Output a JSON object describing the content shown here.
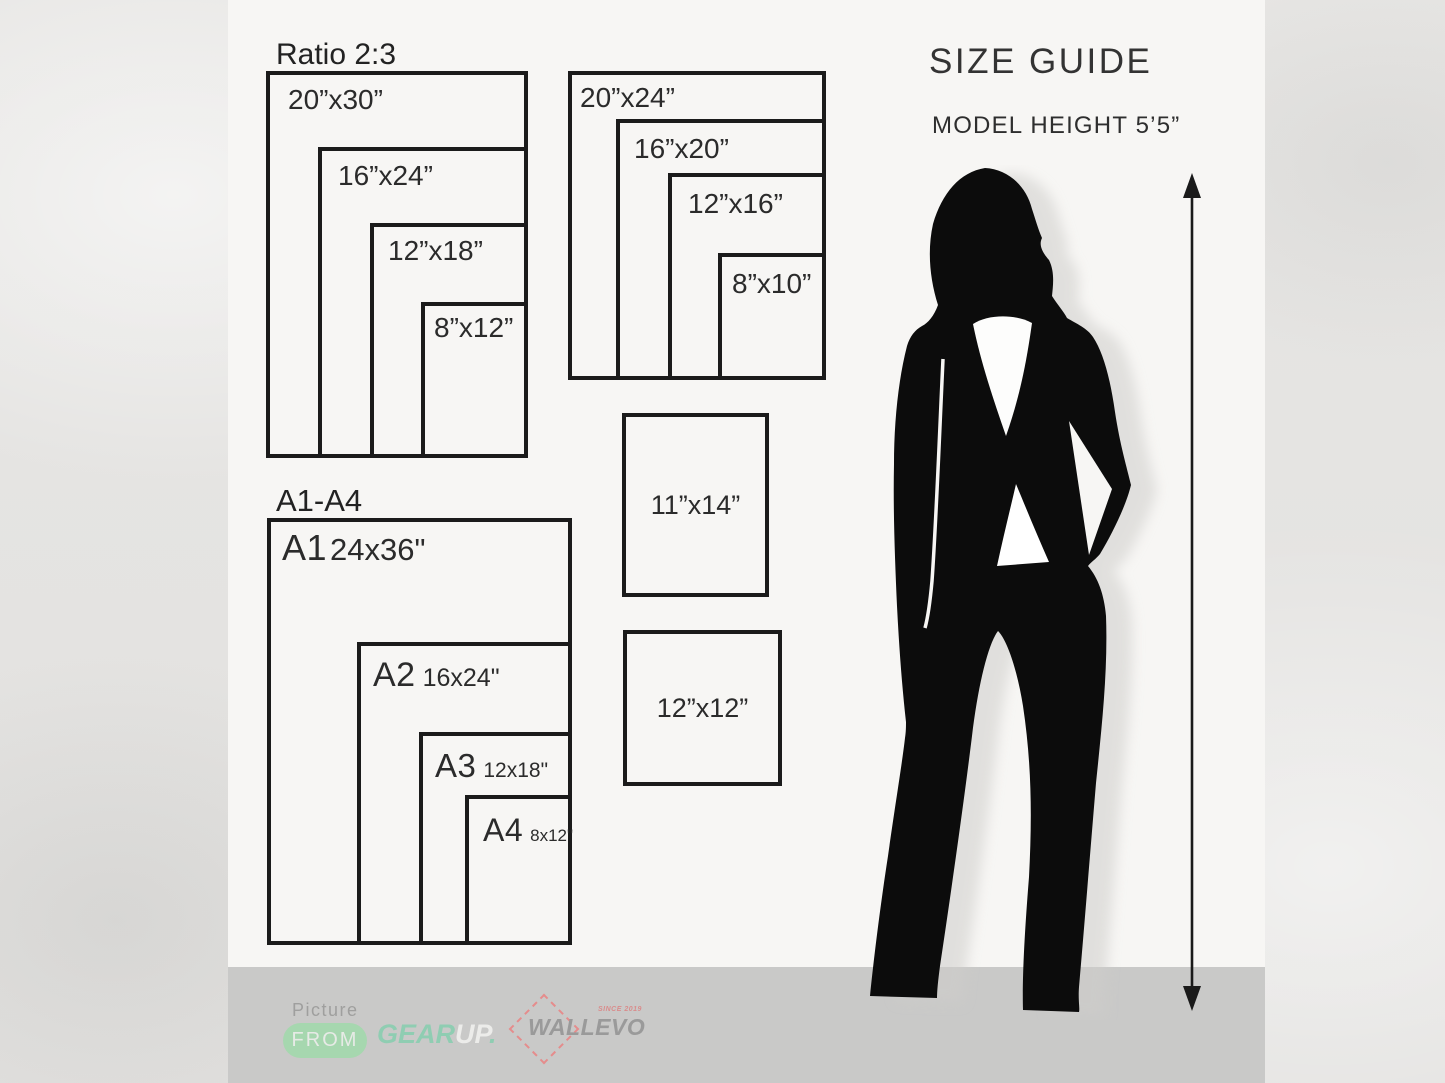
{
  "header": {
    "title": "SIZE GUIDE",
    "model_height": "MODEL HEIGHT 5’5”"
  },
  "ratio_group": {
    "title": "Ratio 2:3",
    "sizes": [
      "20”x30”",
      "16”x24”",
      "12”x18”",
      "8”x12”"
    ]
  },
  "standard_group": {
    "sizes": [
      "20”x24”",
      "16”x20”",
      "12”x16”",
      "8”x10”"
    ]
  },
  "single_sizes": [
    "11”x14”",
    "12”x12”"
  ],
  "a_series": {
    "title": "A1-A4",
    "items": [
      {
        "name": "A1",
        "size": "24x36\""
      },
      {
        "name": "A2",
        "size": "16x24\""
      },
      {
        "name": "A3",
        "size": "12x18\""
      },
      {
        "name": "A4",
        "size": "8x12\""
      }
    ]
  },
  "footer": {
    "picture_label": "Picture",
    "from_badge": "FROM",
    "gearup": {
      "gear": "GEAR",
      "up": "UP",
      "dot": "."
    },
    "wallevo": {
      "name": "WALLEVO",
      "since": "SINCE 2019"
    }
  },
  "colors": {
    "accent_green": "#8fcdb2",
    "badge_green": "#a6d7af",
    "logo_red": "#e58c8c",
    "footer_bar": "#c9c9c8",
    "ink": "#1b1b1b"
  }
}
